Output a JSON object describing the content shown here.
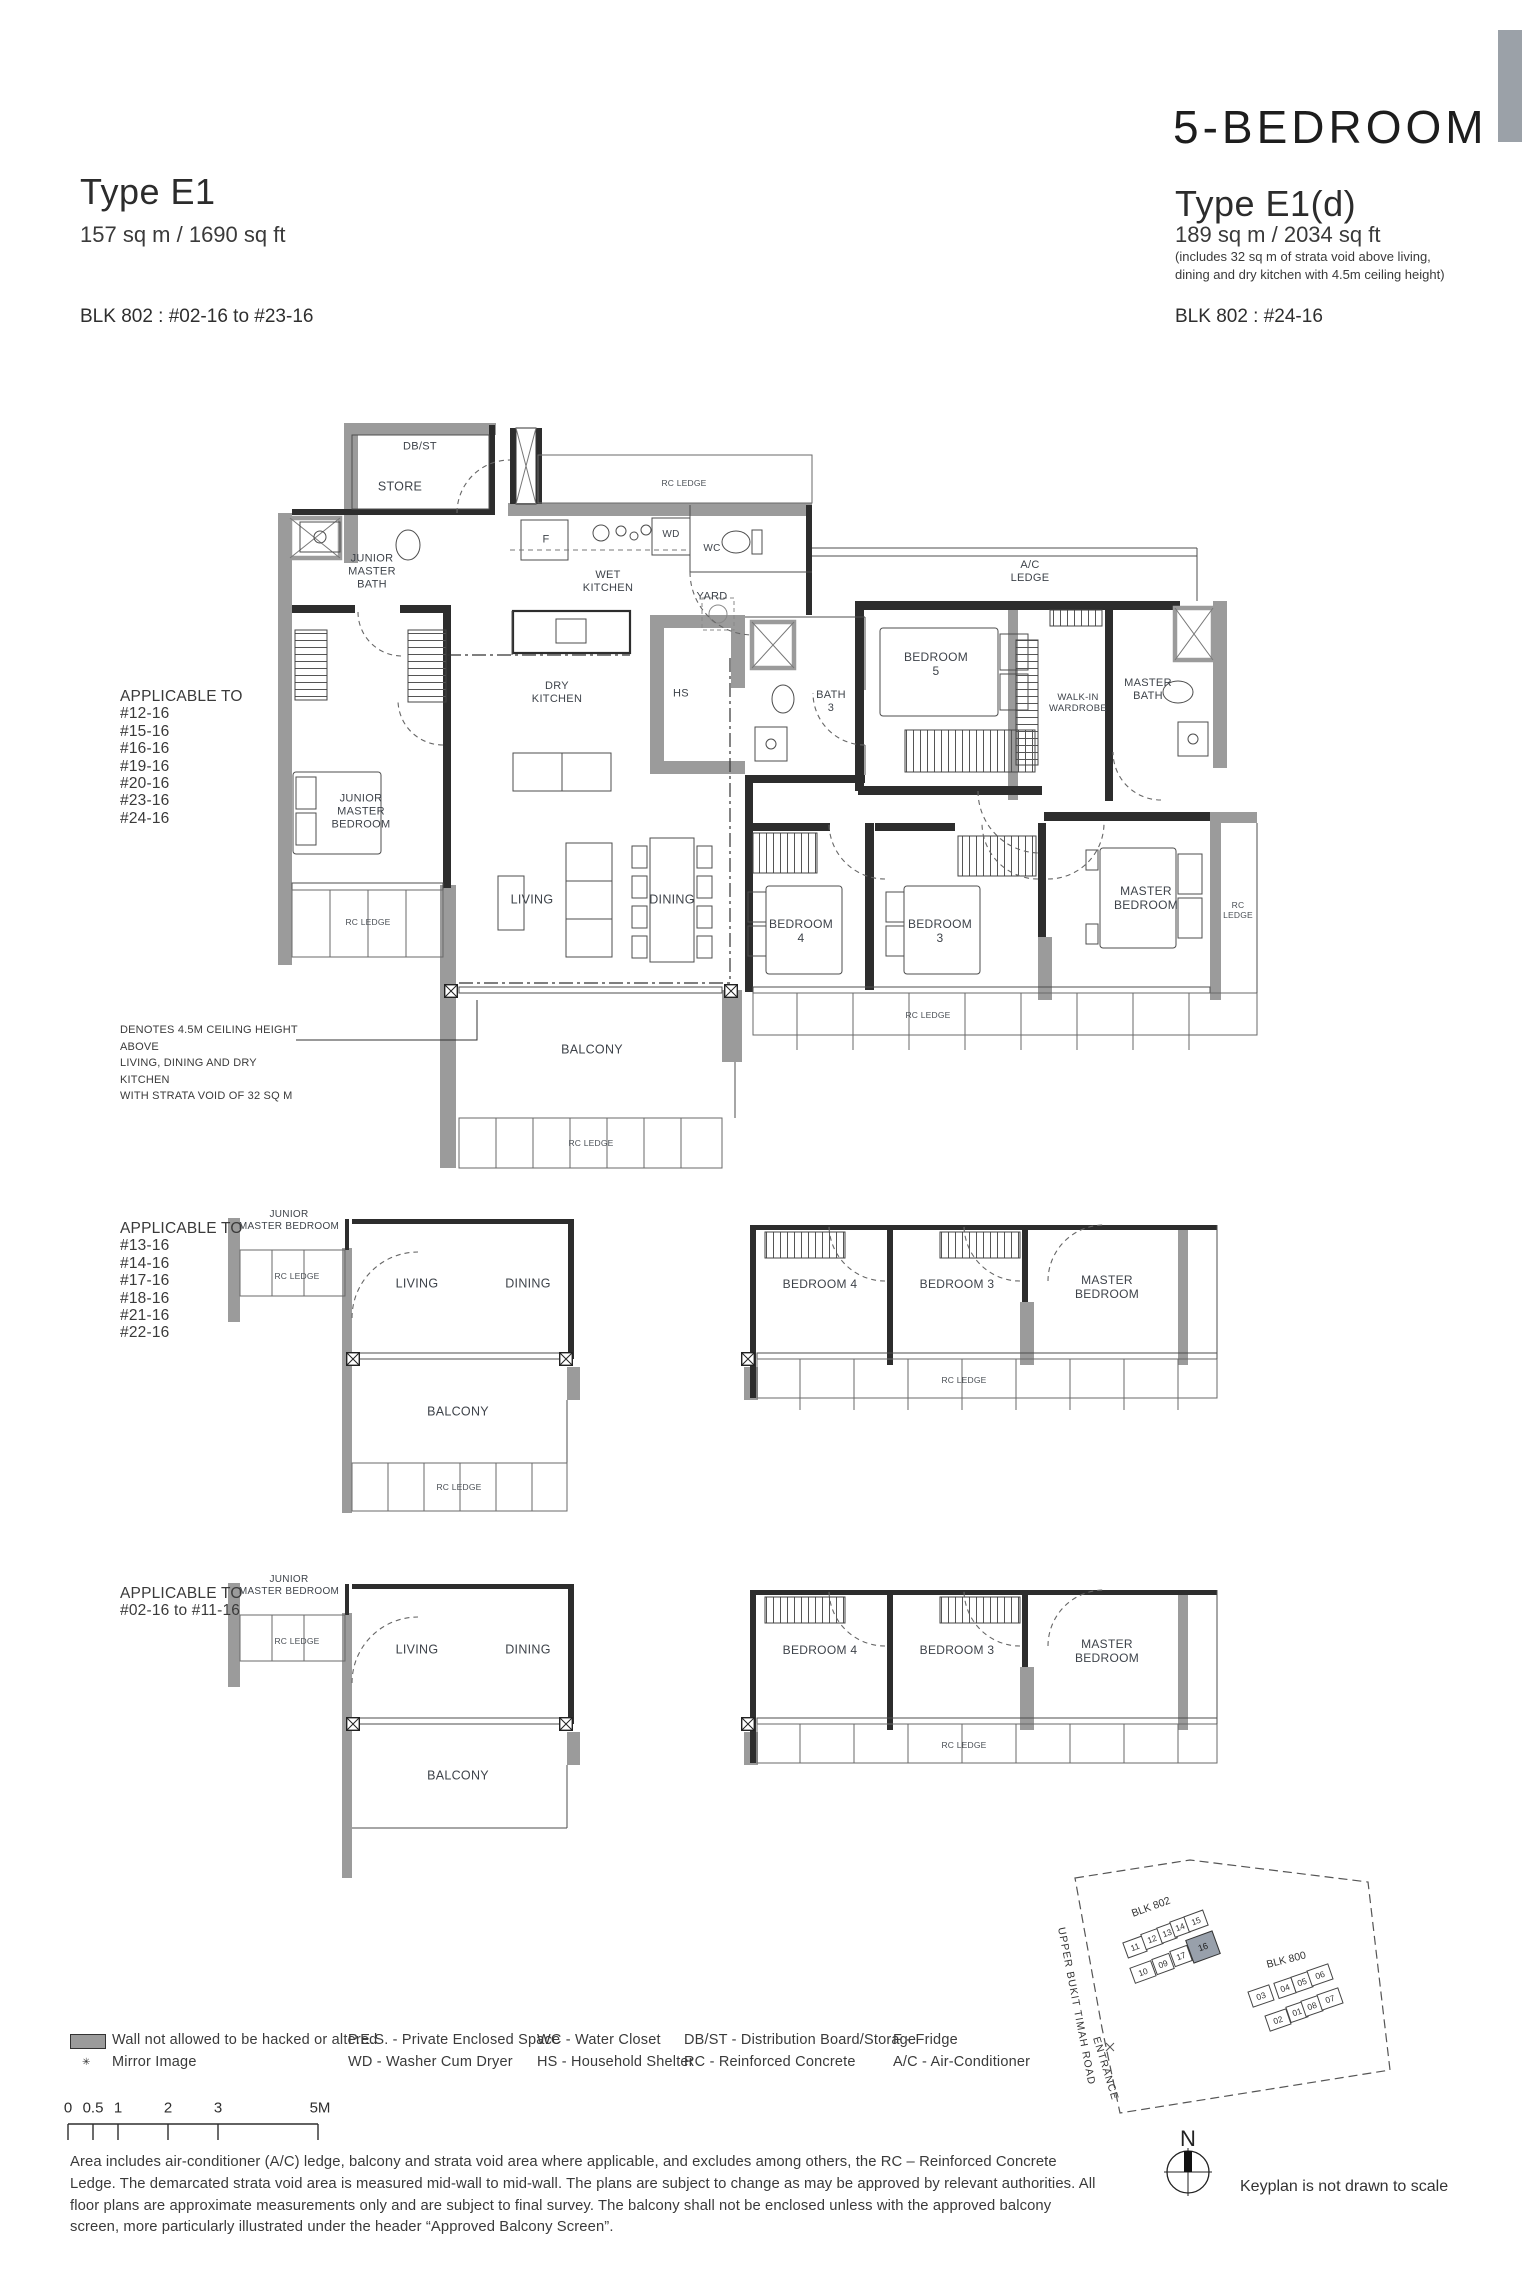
{
  "header": {
    "left": {
      "type": "Type E1",
      "area": "157 sq m / 1690 sq ft",
      "blk": "BLK 802 : #02-16 to #23-16"
    },
    "right": {
      "category": "5-BEDROOM",
      "type": "Type E1(d)",
      "area": "189 sq m / 2034 sq ft",
      "area_note": "(includes 32 sq m of strata void above living,\ndining and dry kitchen with 4.5m ceiling height)",
      "blk": "BLK 802 : #24-16"
    }
  },
  "plan_main": {
    "applicable_title": "APPLICABLE TO",
    "applicable_units": [
      "#12-16",
      "#15-16",
      "#16-16",
      "#19-16",
      "#20-16",
      "#23-16",
      "#24-16"
    ],
    "note": "DENOTES 4.5M CEILING HEIGHT ABOVE\nLIVING, DINING AND DRY KITCHEN\nWITH STRATA VOID OF 32 SQ M",
    "labels": {
      "db_st": "DB/ST",
      "store": "STORE",
      "rc_ledge_top": "RC LEDGE",
      "jm_bath": "JUNIOR\nMASTER\nBATH",
      "fridge": "F",
      "wd": "WD",
      "wc": "WC",
      "wet_kitchen": "WET\nKITCHEN",
      "yard": "YARD",
      "ac_ledge": "A/C\nLEDGE",
      "dry_kitchen": "DRY\nKITCHEN",
      "hs": "HS",
      "bath3": "BATH\n3",
      "bedroom5": "BEDROOM\n5",
      "walkin": "WALK-IN\nWARDROBE",
      "master_bath": "MASTER\nBATH",
      "jm_bedroom": "JUNIOR\nMASTER\nBEDROOM",
      "rc_ledge_left": "RC LEDGE",
      "living": "LIVING",
      "dining": "DINING",
      "bedroom4": "BEDROOM\n4",
      "bedroom3": "BEDROOM\n3",
      "master_bedroom": "MASTER\nBEDROOM",
      "rc_ledge_right": "RC\nLEDGE",
      "rc_ledge_beds": "RC LEDGE",
      "balcony": "BALCONY",
      "rc_ledge_balcony": "RC LEDGE"
    }
  },
  "plan_mid": {
    "applicable_title": "APPLICABLE TO",
    "applicable_units": [
      "#13-16",
      "#14-16",
      "#17-16",
      "#18-16",
      "#21-16",
      "#22-16"
    ],
    "labels": {
      "jm_bedroom": "JUNIOR\nMASTER BEDROOM",
      "rc_ledge_jm": "RC LEDGE",
      "living": "LIVING",
      "dining": "DINING",
      "bedroom4": "BEDROOM 4",
      "bedroom3": "BEDROOM 3",
      "master_bedroom": "MASTER\nBEDROOM",
      "balcony": "BALCONY",
      "rc_ledge_balcony": "RC LEDGE",
      "rc_ledge_beds": "RC LEDGE"
    }
  },
  "plan_low": {
    "applicable_title": "APPLICABLE TO",
    "applicable_range": "#02-16 to #11-16",
    "labels": {
      "jm_bedroom": "JUNIOR\nMASTER BEDROOM",
      "rc_ledge_jm": "RC LEDGE",
      "living": "LIVING",
      "dining": "DINING",
      "bedroom4": "BEDROOM 4",
      "bedroom3": "BEDROOM 3",
      "master_bedroom": "MASTER\nBEDROOM",
      "balcony": "BALCONY",
      "rc_ledge_beds": "RC LEDGE"
    }
  },
  "legend": {
    "mirror_marker": "✳",
    "wall": "Wall not allowed to be hacked or altered",
    "mirror": "Mirror Image",
    "pes": "P.E.S. - Private Enclosed Space",
    "wd": "WD - Washer Cum Dryer",
    "wc": "WC - Water Closet",
    "hs": "HS - Household Shelter",
    "dbst": "DB/ST - Distribution Board/Storage",
    "rc": "RC - Reinforced Concrete",
    "f": "F - Fridge",
    "ac": "A/C - Air-Conditioner"
  },
  "scale": {
    "ticks": [
      "0",
      "0.5",
      "1",
      "2",
      "3",
      "5M"
    ]
  },
  "disclaimer": "Area includes air-conditioner (A/C) ledge, balcony and strata void area where applicable, and excludes among others, the RC – Reinforced Concrete\nLedge. The demarcated strata void area is measured mid-wall to mid-wall. The plans are subject to change as may be approved by relevant authorities. All\nfloor plans are approximate measurements only and are subject to final survey. The balcony shall not be enclosed unless with the approved balcony\nscreen, more particularly illustrated under the header “Approved Balcony Screen”.",
  "keyplan": {
    "blk802": "BLK 802",
    "blk800": "BLK 800",
    "road": "UPPER BUKIT TIMAH ROAD",
    "entrance": "ENTRANCE",
    "north": "N",
    "note": "Keyplan is not drawn to scale",
    "highlight": "16",
    "highlight_color": "#98a0ab",
    "u802": [
      "11",
      "12",
      "13",
      "14",
      "15",
      "10",
      "09",
      "17"
    ],
    "u800": [
      "03",
      "04",
      "05",
      "06",
      "02",
      "01",
      "08",
      "07"
    ]
  }
}
